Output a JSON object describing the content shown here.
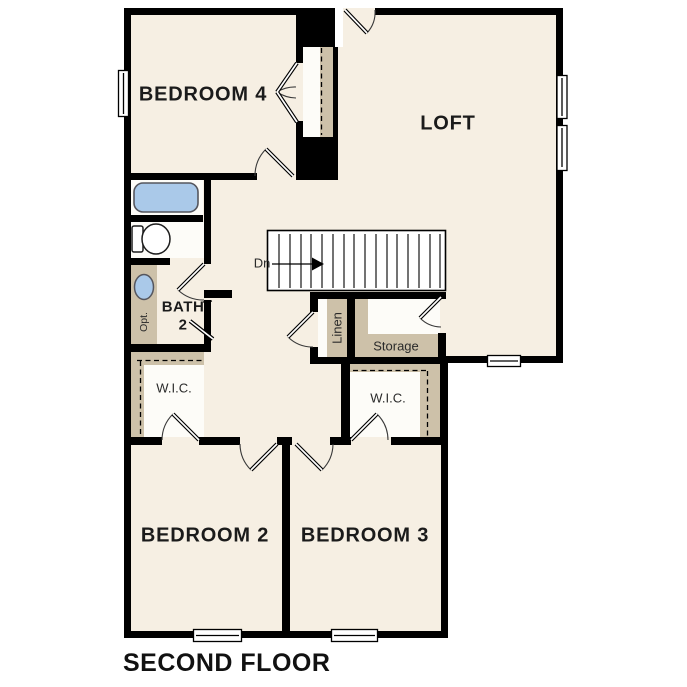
{
  "plan": {
    "caption": "SECOND FLOOR",
    "rooms": {
      "bedroom4": "BEDROOM 4",
      "loft": "LOFT",
      "bedroom2": "BEDROOM 2",
      "bedroom3": "BEDROOM 3"
    },
    "bath": {
      "line1": "BATH",
      "line2": "2"
    },
    "closets": {
      "wic_left": "W.I.C.",
      "wic_right": "W.I.C.",
      "linen": "Linen",
      "storage": "Storage"
    },
    "stairs": {
      "direction": "Dn"
    },
    "fixtures": {
      "vanity_note": "Opt."
    },
    "colors": {
      "floor": "#f6efe3",
      "shelving": "#cdc1a9",
      "fixture_blue": "#aac9e9",
      "wall": "#000000"
    }
  }
}
